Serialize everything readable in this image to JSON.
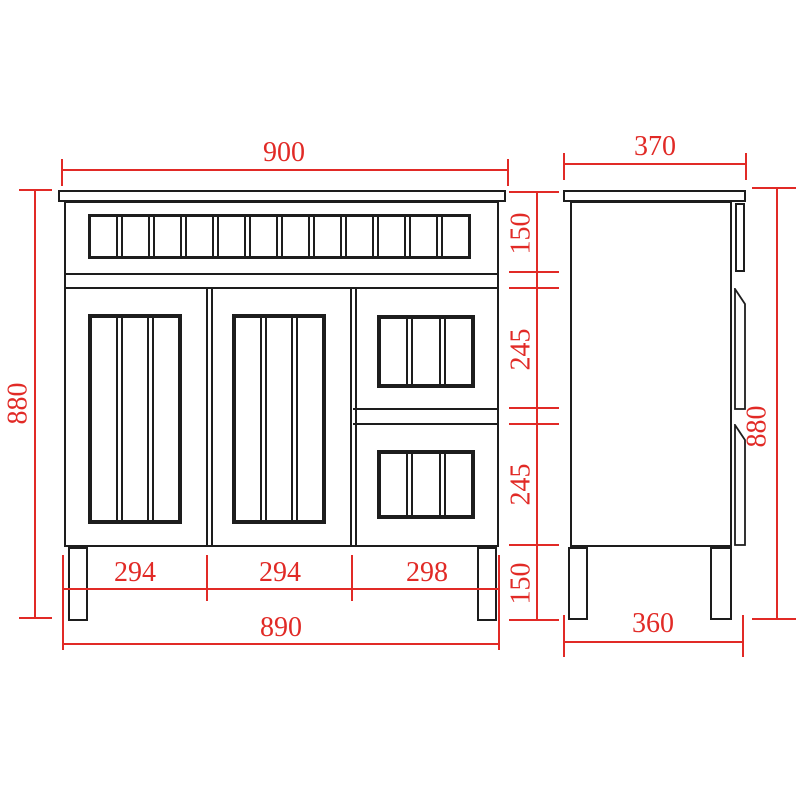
{
  "front_view": {
    "width_top": "900",
    "height_left": "880",
    "right_chain": [
      "150",
      "245",
      "245",
      "150"
    ],
    "bottom_segments": [
      "294",
      "294",
      "298"
    ],
    "width_bottom": "890",
    "slat_sections": 12,
    "panel_sections": 3
  },
  "side_view": {
    "width_top": "370",
    "height_right": "880",
    "width_bottom": "360"
  },
  "colors": {
    "dimension_red": "#e12a26",
    "outline_black": "#1d1d1d",
    "background": "#ffffff"
  }
}
